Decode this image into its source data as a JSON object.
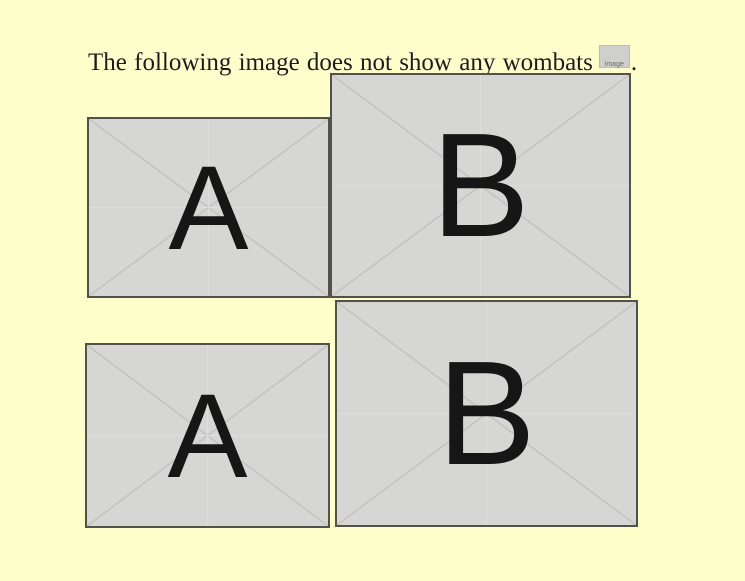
{
  "sentence": {
    "text": "The following image does not show any wombats",
    "inline_image_label": "image",
    "period": "."
  },
  "images": [
    {
      "position": "top-left",
      "letter": "A"
    },
    {
      "position": "top-right",
      "letter": "B"
    },
    {
      "position": "bottom-left",
      "letter": "A"
    },
    {
      "position": "bottom-right",
      "letter": "B"
    }
  ],
  "colors": {
    "page_background": "#ffffcc",
    "placeholder_background": "#d6d6d4",
    "placeholder_border": "#52524b",
    "placeholder_line": "#c6c2bd",
    "letter_color": "#161616",
    "text_color": "#1c1c1c",
    "broken_image_background": "#cfcfce"
  }
}
